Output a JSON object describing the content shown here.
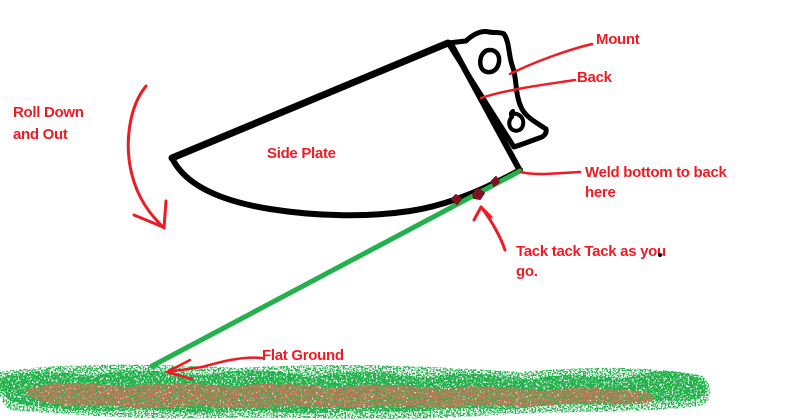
{
  "diagram": {
    "labels": {
      "roll": {
        "line1": "Roll Down",
        "line2": "and Out"
      },
      "side_plate": "Side Plate",
      "mount": "Mount",
      "back": "Back",
      "weld": {
        "line1": "Weld bottom to back",
        "line2": "here"
      },
      "tack": {
        "line1": "Tack tack Tack as you",
        "line2": "go."
      },
      "flat_ground": "Flat Ground"
    },
    "colors": {
      "annotation_red": "#ED1C24",
      "outline_black": "#000000",
      "weld_green": "#22B14C",
      "tack_dark_red": "#7D1320",
      "ground_green": "#22B14C",
      "ground_brown": "#B97A57",
      "background": "#FFFFFF"
    }
  }
}
